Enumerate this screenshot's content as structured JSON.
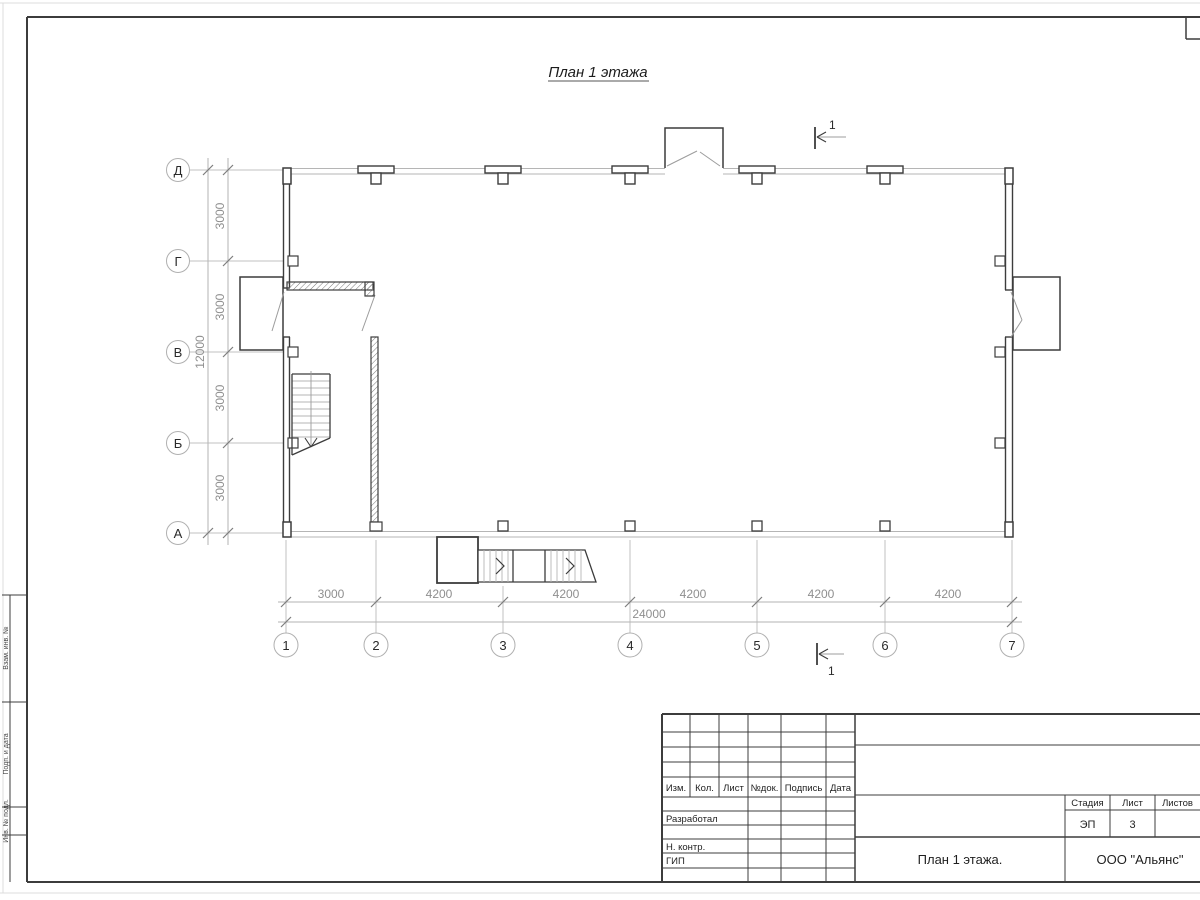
{
  "sheet_title": "План 1 этажа",
  "plan": {
    "vertical_axes": [
      "Д",
      "Г",
      "В",
      "Б",
      "А"
    ],
    "horizontal_axes": [
      "1",
      "2",
      "3",
      "4",
      "5",
      "6",
      "7"
    ],
    "vertical_dims": [
      "3000",
      "3000",
      "3000",
      "3000"
    ],
    "vertical_total": "12000",
    "horizontal_dims": [
      "3000",
      "4200",
      "4200",
      "4200",
      "4200",
      "4200"
    ],
    "horizontal_total": "24000",
    "section_label_top": "1",
    "section_label_bottom": "1"
  },
  "title_block": {
    "revision_headers": [
      "Изм.",
      "Кол.",
      "Лист",
      "№док.",
      "Подпись",
      "Дата"
    ],
    "role_rows": [
      "Разработал",
      "Н. контр.",
      "ГИП"
    ],
    "stage_label": "Стадия",
    "stage_value": "ЭП",
    "sheet_label": "Лист",
    "sheet_value": "3",
    "sheets_label": "Листов",
    "drawing_title": "План 1 этажа.",
    "company": "ООО \"Альянс\""
  },
  "side_stamp": {
    "labels": [
      "Взам. инв. №",
      "Подп. и дата",
      "Инв. № подл."
    ]
  },
  "colors": {
    "line_dark": "#3c3c3c",
    "line_light": "#b5b5b5",
    "dim_text": "#8f8f8f"
  }
}
